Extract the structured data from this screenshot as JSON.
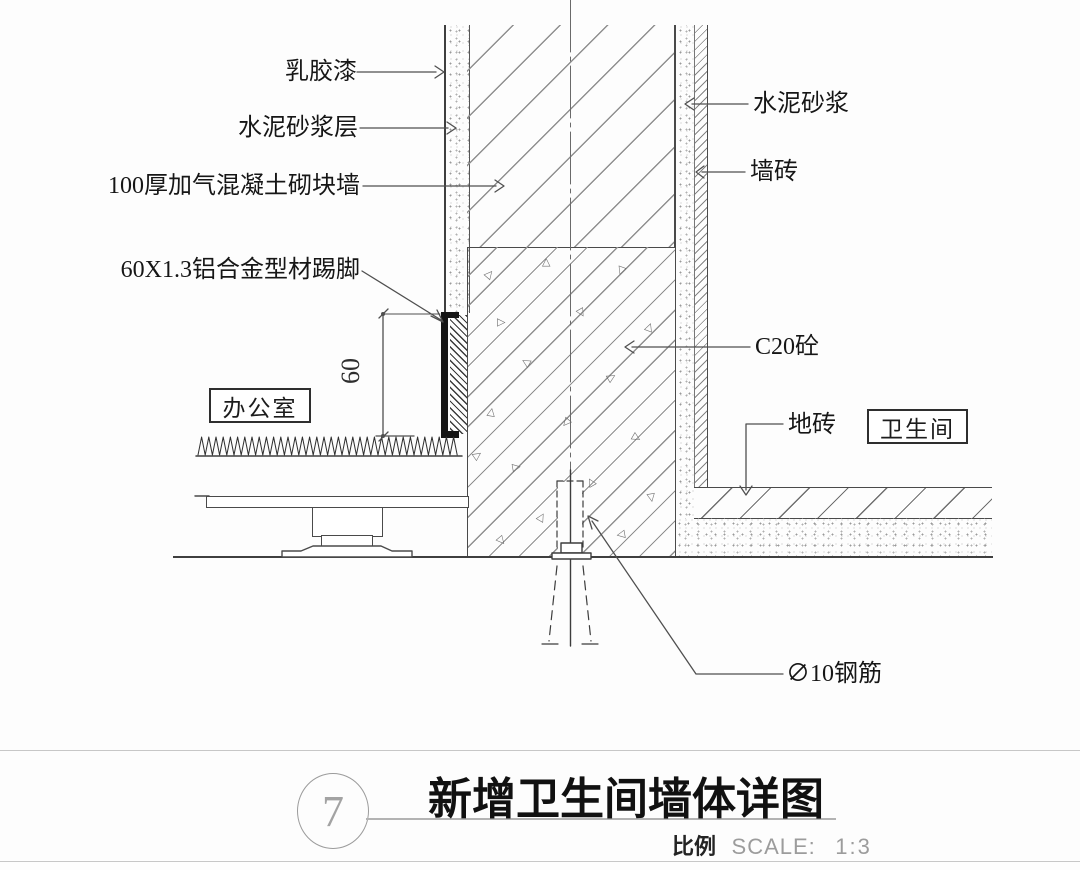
{
  "colors": {
    "ink": "#3a3a3a",
    "hatch": "#8f8f8f",
    "muted": "#9c9c9c"
  },
  "annotations": {
    "latex_paint": "乳胶漆",
    "cement_mortar_layer": "水泥砂浆层",
    "block_wall": "100厚加气混凝土砌块墙",
    "skirting": "60X1.3铝合金型材踢脚",
    "cement_mortar": "水泥砂浆",
    "wall_tile": "墙砖",
    "c20_concrete": "C20砼",
    "floor_tile": "地砖",
    "rebar": "∅10钢筋"
  },
  "rooms": {
    "office": "办公室",
    "bathroom": "卫生间"
  },
  "dimensions": {
    "skirting_height": "60"
  },
  "symbols": {
    "aggregate": "△"
  },
  "title_block": {
    "detail_number": "7",
    "title": "新增卫生间墙体详图",
    "scale_label": "比例",
    "scale_text": "SCALE:",
    "scale_value": "1:3"
  }
}
